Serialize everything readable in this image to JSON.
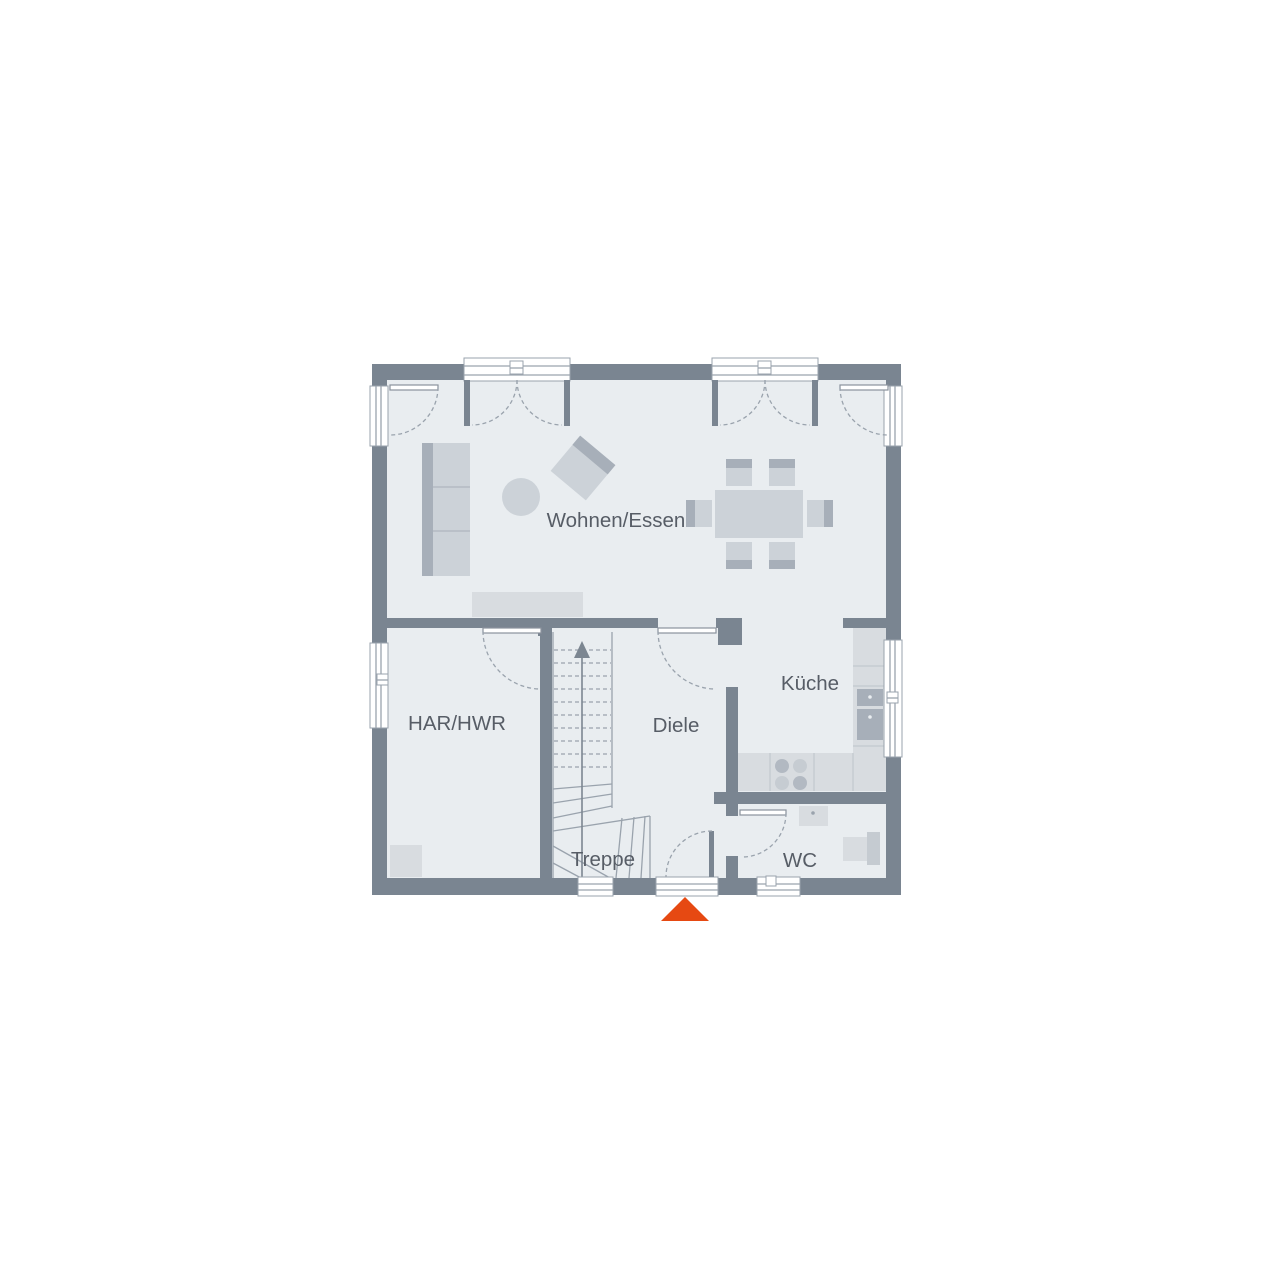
{
  "rooms": {
    "wohnen_essen": {
      "label": "Wohnen/Essen"
    },
    "kueche": {
      "label": "Küche"
    },
    "har_hwr": {
      "label": "HAR/HWR"
    },
    "diele": {
      "label": "Diele"
    },
    "treppe": {
      "label": "Treppe"
    },
    "wc": {
      "label": "WC"
    }
  },
  "entrance": {
    "marker_icon": "triangle-up"
  },
  "stair": {
    "direction_icon": "arrow-up"
  },
  "colors": {
    "wall": "#7a8591",
    "floor": "#e9edf0",
    "furniture": "#ccd2d8",
    "furniture-light": "#d8dce0",
    "furniture-mid": "#c5cbd1",
    "furniture-dark": "#a7afb9",
    "stroke": "#9aa3ad",
    "text": "#575d66",
    "accent": "#e64912"
  }
}
